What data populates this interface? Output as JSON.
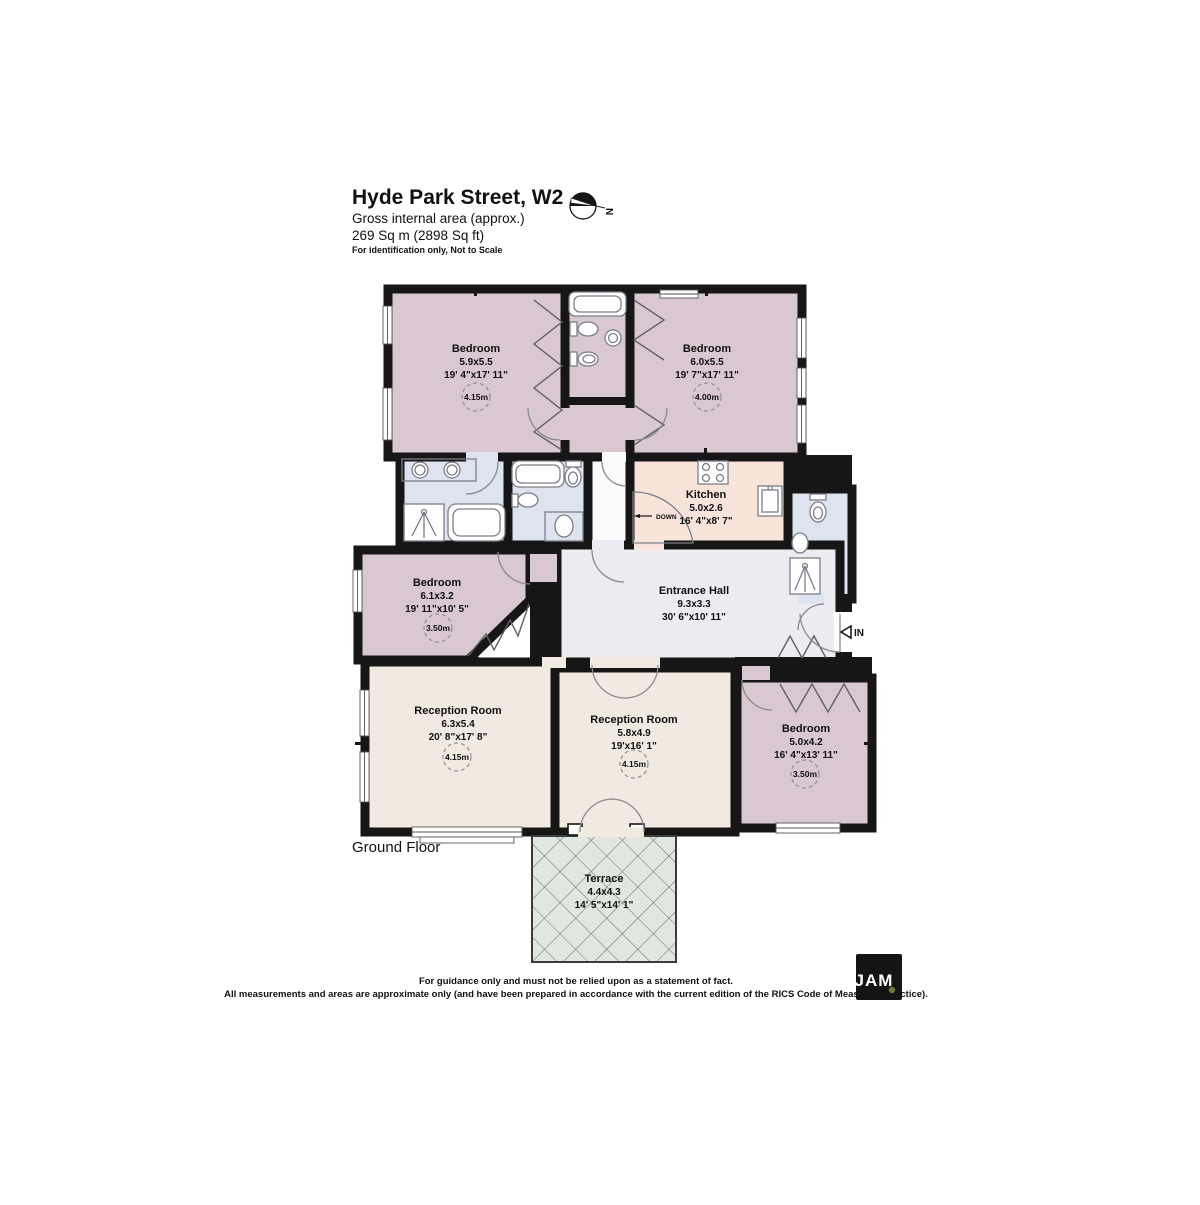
{
  "header": {
    "title": "Hyde Park Street, W2",
    "subtitle": "Gross internal area (approx.)",
    "area": "269 Sq m (2898 Sq ft)",
    "note": "For identification only, Not to Scale",
    "compass_label": "N"
  },
  "floor_label": "Ground Floor",
  "rooms": [
    {
      "name": "Bedroom",
      "dims_m": "5.9x5.5",
      "dims_ft": "19' 4\"x17' 11\"",
      "height": "4.15m"
    },
    {
      "name": "Bedroom",
      "dims_m": "6.0x5.5",
      "dims_ft": "19' 7\"x17' 11\"",
      "height": "4.00m"
    },
    {
      "name": "Kitchen",
      "dims_m": "5.0x2.6",
      "dims_ft": "16' 4\"x8' 7\""
    },
    {
      "name": "Bedroom",
      "dims_m": "6.1x3.2",
      "dims_ft": "19' 11\"x10' 5\"",
      "height": "3.50m"
    },
    {
      "name": "Entrance Hall",
      "dims_m": "9.3x3.3",
      "dims_ft": "30' 6\"x10' 11\""
    },
    {
      "name": "Reception Room",
      "dims_m": "6.3x5.4",
      "dims_ft": "20' 8\"x17' 8\"",
      "height": "4.15m"
    },
    {
      "name": "Reception Room",
      "dims_m": "5.8x4.9",
      "dims_ft": "19'x16' 1\"",
      "height": "4.15m"
    },
    {
      "name": "Bedroom",
      "dims_m": "5.0x4.2",
      "dims_ft": "16' 4\"x13' 11\"",
      "height": "3.50m"
    },
    {
      "name": "Terrace",
      "dims_m": "4.4x4.3",
      "dims_ft": "14' 5\"x14' 1\""
    }
  ],
  "annotations": {
    "down": "DOWN",
    "in": "IN"
  },
  "footer": {
    "line1": "For guidance only and must not be relied upon as a statement of fact.",
    "line2": "All measurements and areas are approximate only (and have been prepared in accordance with the current edition of the RICS Code of Measuring Practice)."
  },
  "logo": {
    "text": "JAM"
  },
  "colors": {
    "wall": "#161616",
    "bedroom": "#d9c8d1",
    "bath": "#dee4ef",
    "kitchen": "#f9e4dc",
    "hall": "#ecebf2",
    "reception": "#f1eae1",
    "terrace": "#e0e7e0",
    "corridor": "#fbfbfb",
    "logo_dot": "#6b7a3f",
    "logo_bg": "#141414"
  }
}
